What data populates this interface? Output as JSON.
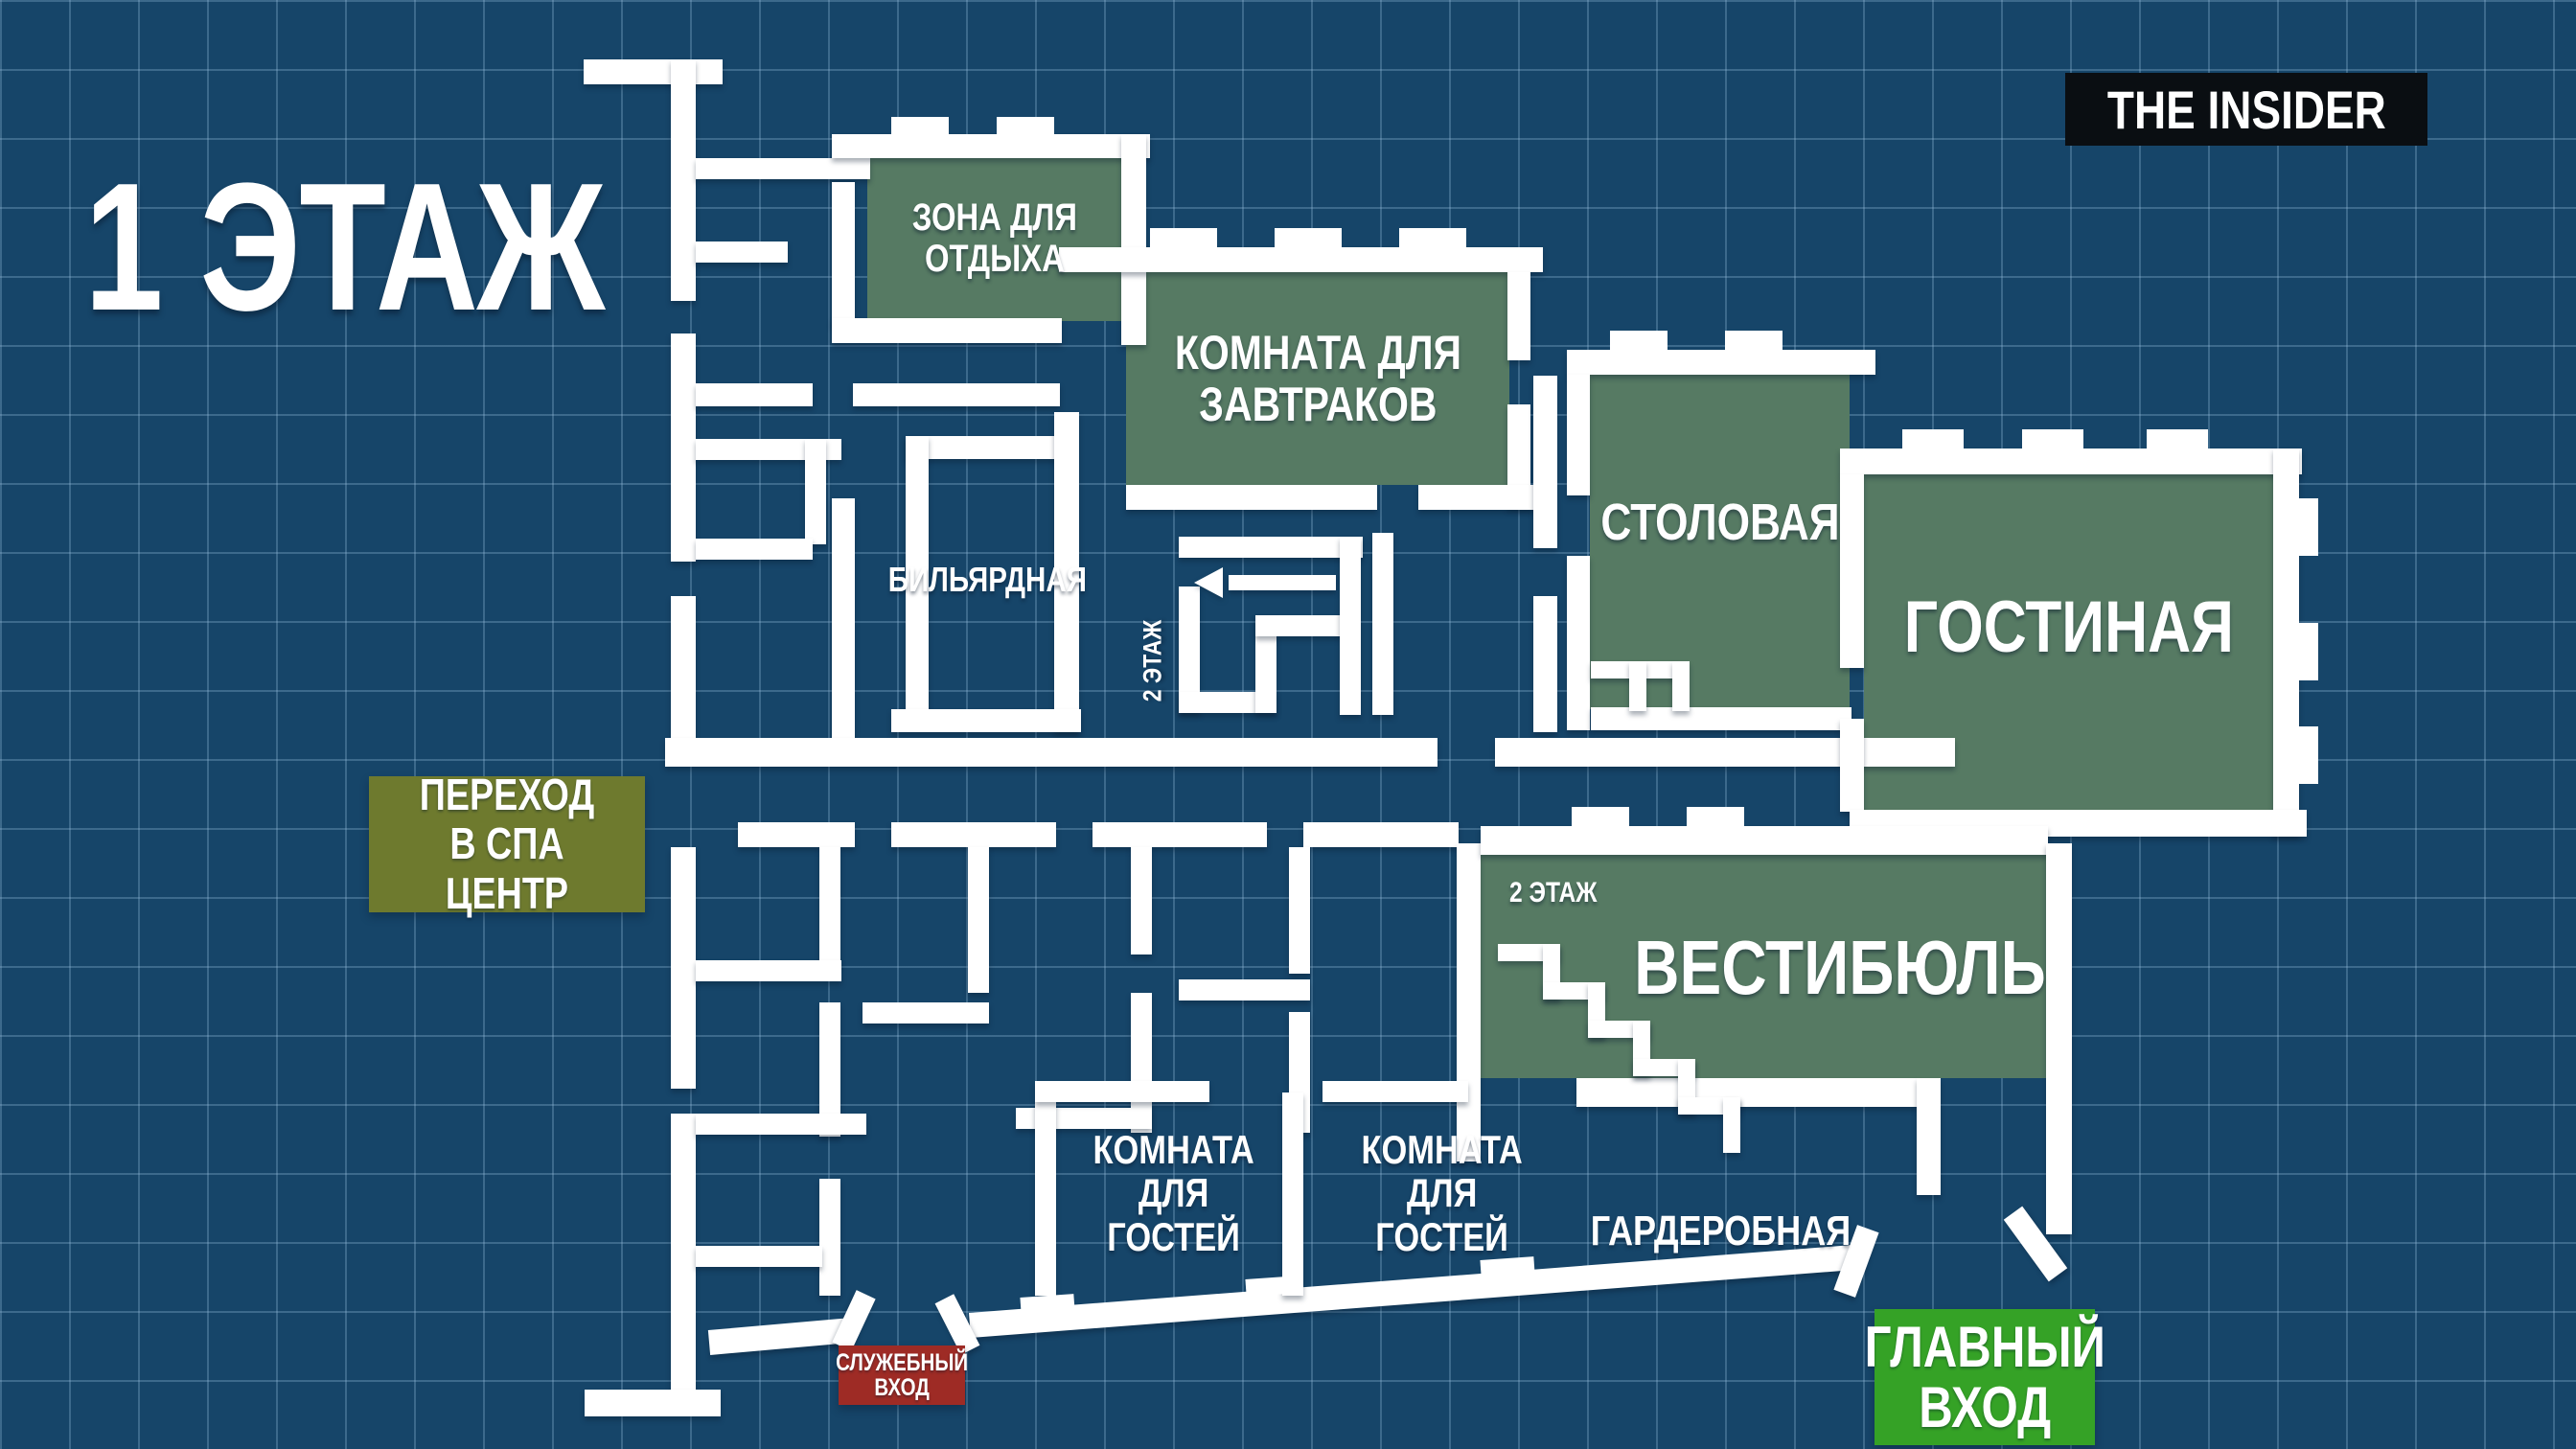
{
  "header": {
    "floor_title": "1 ЭТАЖ",
    "logo": "THE INSIDER"
  },
  "rooms": {
    "rest_zone": "ЗОНА ДЛЯ\nОТДЫХА",
    "breakfast_room": "КОМНАТА ДЛЯ\nЗАВТРАКОВ",
    "dining_room": "СТОЛОВАЯ",
    "living_room": "ГОСТИНАЯ",
    "billiard_room": "БИЛЬЯРДНАЯ",
    "vestibule": "ВЕСТИБЮЛЬ",
    "cloakroom": "ГАРДЕРОБНАЯ",
    "guest_room": "КОМНАТА\nДЛЯ\nГОСТЕЙ",
    "floor2_stairs": "2 ЭТАЖ"
  },
  "badges": {
    "spa_passage": "ПЕРЕХОД\nВ СПА ЦЕНТР",
    "service_entrance": "СЛУЖЕБНЫЙ\nВХОД",
    "main_entrance": "ГЛАВНЫЙ\nВХОД"
  },
  "colors": {
    "background": "#164569",
    "grid_line": "#96becb",
    "wall": "#ffffff",
    "room_fill": "#567a63",
    "spa_badge": "#6e7a2e",
    "service_badge": "#9e2b25",
    "main_entrance_badge": "#35a226",
    "logo_background": "#0a0e12"
  }
}
